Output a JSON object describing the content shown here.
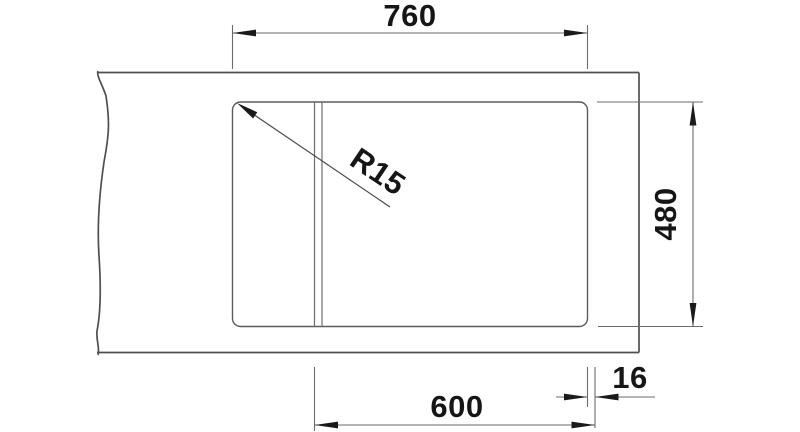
{
  "drawing": {
    "type": "technical-dimension-drawing",
    "subject": "worktop-with-rectangular-cutout",
    "colors": {
      "background": "#ffffff",
      "outline": "#4f4f4f",
      "dimension_lines": "#6b6b6b",
      "text": "#161616"
    },
    "labels": {
      "top_dimension": "760",
      "right_dimension": "480",
      "bottom_dimension": "600",
      "bottom_offset_dimension": "16",
      "radius_label": "R15"
    }
  }
}
